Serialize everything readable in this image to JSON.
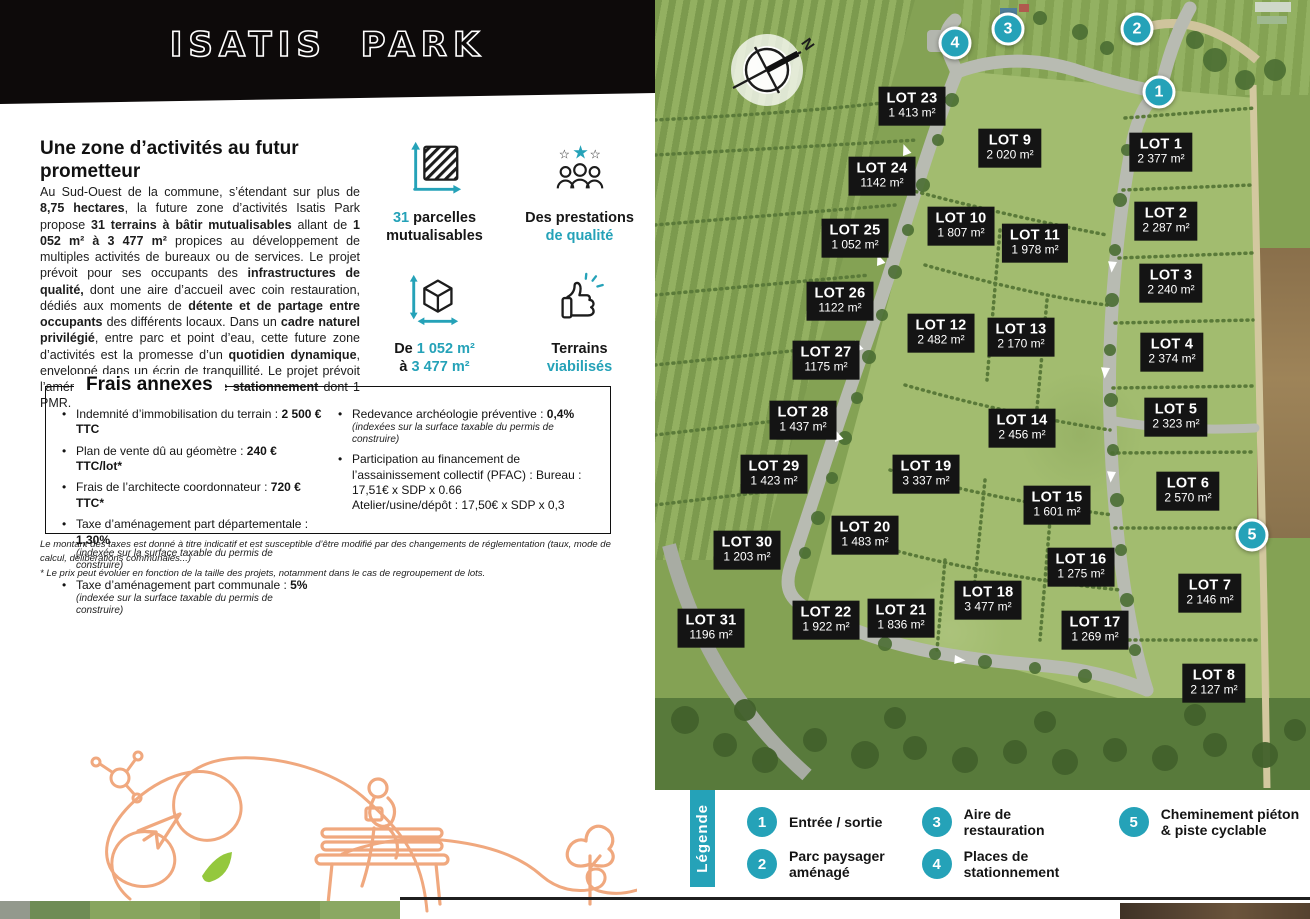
{
  "banner": {
    "title": "ISATIS PARK"
  },
  "intro": {
    "heading": "Une zone d’activités au futur prometteur",
    "paragraph": [
      {
        "t": "Au Sud-Ouest de la commune, s’étendant sur plus de "
      },
      {
        "t": "8,75 hectares",
        "b": 1
      },
      {
        "t": ", la future zone d’activités Isatis Park propose "
      },
      {
        "t": "31 terrains à bâtir mutualisables",
        "b": 1
      },
      {
        "t": " allant de "
      },
      {
        "t": "1 052 m² à 3 477 m²",
        "b": 1
      },
      {
        "t": " propices au développement de multiples activités de bureaux ou de services. Le projet prévoit pour ses occupants des "
      },
      {
        "t": "infrastructures de qualité,",
        "b": 1
      },
      {
        "t": " dont une aire d’accueil avec coin restauration, dédiés aux moments de "
      },
      {
        "t": "détente et de partage entre occupants",
        "b": 1
      },
      {
        "t": " des différents locaux. Dans un "
      },
      {
        "t": "cadre naturel privilégié",
        "b": 1
      },
      {
        "t": ", entre parc et point d’eau, cette future zone d’activités est la promesse d’un "
      },
      {
        "t": "quotidien dynamique",
        "b": 1
      },
      {
        "t": ", enveloppé dans un écrin de tranquillité. Le projet prévoit l’aménagement de "
      },
      {
        "t": "10 places de stationnement",
        "b": 1
      },
      {
        "t": " dont 1 PMR."
      }
    ]
  },
  "features": [
    {
      "icon": "area-icon",
      "l1": [
        {
          "t": "31 ",
          "a": 1
        },
        {
          "t": "parcelles"
        }
      ],
      "l2": [
        {
          "t": "mutualisables"
        }
      ]
    },
    {
      "icon": "quality-stars-people-icon",
      "l1": [
        {
          "t": "Des prestations"
        }
      ],
      "l2": [
        {
          "t": "de qualité",
          "a": 1
        }
      ]
    },
    {
      "icon": "plot-size-cube-icon",
      "l1": [
        {
          "t": "De "
        },
        {
          "t": "1 052 m²",
          "a": 1
        }
      ],
      "l2": [
        {
          "t": "à "
        },
        {
          "t": "3 477 m²",
          "a": 1
        }
      ]
    },
    {
      "icon": "thumb-up-icon",
      "l1": [
        {
          "t": "Terrains"
        }
      ],
      "l2": [
        {
          "t": "viabilisés",
          "a": 1
        }
      ]
    }
  ],
  "fees": {
    "title": "Frais annexes",
    "left": [
      {
        "label": "Indemnité d’immobilisation du terrain : ",
        "value": "2 500 € TTC"
      },
      {
        "label": "Plan de vente dû au géomètre : ",
        "value": "240 € TTC/lot*"
      },
      {
        "label": "Frais de l’architecte coordonnateur : ",
        "value": "720 € TTC*"
      },
      {
        "label": "Taxe d’aménagement part départementale : ",
        "value": "1,30%",
        "note": "(indexée sur la surface taxable du permis de construire)"
      },
      {
        "label": "Taxe d’aménagement part communale : ",
        "value": "5%",
        "note": "(indexée sur la surface taxable du permis de construire)"
      }
    ],
    "right": [
      {
        "label": "Redevance archéologie préventive : ",
        "value": "0,4%",
        "note": "(indexées sur la surface taxable du permis de construire)"
      },
      {
        "label": "Participation au financement de l’assainissement collectif (PFAC) : Bureau : 17,51€ x SDP x 0.66",
        "line2": "Atelier/usine/dépôt : 17,50€ x SDP x 0,3"
      }
    ]
  },
  "disclaimer": {
    "line1": "Le montant des taxes est donné à titre indicatif et est susceptible d’être modifié par des changements de réglementation (taux, mode de calcul, délibérations communales...)",
    "line2": "* Le prix peut évoluer en fonction de la taille des projets, notamment dans le cas de regroupement de lots."
  },
  "map": {
    "compass_label": "N",
    "lots": [
      {
        "name": "LOT 23",
        "area": "1 413 m²",
        "x": 257,
        "y": 106
      },
      {
        "name": "LOT 9",
        "area": "2 020 m²",
        "x": 355,
        "y": 148
      },
      {
        "name": "LOT 1",
        "area": "2 377 m²",
        "x": 506,
        "y": 152
      },
      {
        "name": "LOT 24",
        "area": "1142 m²",
        "x": 227,
        "y": 176
      },
      {
        "name": "LOT 2",
        "area": "2 287 m²",
        "x": 511,
        "y": 221
      },
      {
        "name": "LOT 25",
        "area": "1 052 m²",
        "x": 200,
        "y": 238
      },
      {
        "name": "LOT 10",
        "area": "1 807 m²",
        "x": 306,
        "y": 226
      },
      {
        "name": "LOT 11",
        "area": "1 978 m²",
        "x": 380,
        "y": 243
      },
      {
        "name": "LOT 3",
        "area": "2 240 m²",
        "x": 516,
        "y": 283
      },
      {
        "name": "LOT 26",
        "area": "1122 m²",
        "x": 185,
        "y": 301
      },
      {
        "name": "LOT 12",
        "area": "2 482 m²",
        "x": 286,
        "y": 333
      },
      {
        "name": "LOT 13",
        "area": "2 170 m²",
        "x": 366,
        "y": 337
      },
      {
        "name": "LOT 27",
        "area": "1175 m²",
        "x": 171,
        "y": 360
      },
      {
        "name": "LOT 4",
        "area": "2 374 m²",
        "x": 517,
        "y": 352
      },
      {
        "name": "LOT 28",
        "area": "1 437 m²",
        "x": 148,
        "y": 420
      },
      {
        "name": "LOT 14",
        "area": "2 456 m²",
        "x": 367,
        "y": 428
      },
      {
        "name": "LOT 5",
        "area": "2 323 m²",
        "x": 521,
        "y": 417
      },
      {
        "name": "LOT 29",
        "area": "1 423 m²",
        "x": 119,
        "y": 474
      },
      {
        "name": "LOT 19",
        "area": "3 337 m²",
        "x": 271,
        "y": 474
      },
      {
        "name": "LOT 15",
        "area": "1 601 m²",
        "x": 402,
        "y": 505
      },
      {
        "name": "LOT 6",
        "area": "2 570 m²",
        "x": 533,
        "y": 491
      },
      {
        "name": "LOT 30",
        "area": "1 203 m²",
        "x": 92,
        "y": 550
      },
      {
        "name": "LOT 20",
        "area": "1 483 m²",
        "x": 210,
        "y": 535
      },
      {
        "name": "LOT 16",
        "area": "1 275 m²",
        "x": 426,
        "y": 567
      },
      {
        "name": "LOT 18",
        "area": "3 477 m²",
        "x": 333,
        "y": 600
      },
      {
        "name": "LOT 7",
        "area": "2 146 m²",
        "x": 555,
        "y": 593
      },
      {
        "name": "LOT 22",
        "area": "1 922 m²",
        "x": 171,
        "y": 620
      },
      {
        "name": "LOT 21",
        "area": "1 836 m²",
        "x": 246,
        "y": 618
      },
      {
        "name": "LOT 31",
        "area": "1196 m²",
        "x": 56,
        "y": 628
      },
      {
        "name": "LOT 17",
        "area": "1 269 m²",
        "x": 440,
        "y": 630
      },
      {
        "name": "LOT 8",
        "area": "2 127 m²",
        "x": 559,
        "y": 683
      }
    ],
    "markers": [
      {
        "n": "1",
        "x": 504,
        "y": 92
      },
      {
        "n": "2",
        "x": 482,
        "y": 29
      },
      {
        "n": "3",
        "x": 353,
        "y": 29
      },
      {
        "n": "4",
        "x": 300,
        "y": 43
      },
      {
        "n": "5",
        "x": 597,
        "y": 535
      }
    ]
  },
  "legend": {
    "title": "Légende",
    "columns": [
      [
        {
          "n": "1",
          "label": "Entrée / sortie",
          "w": 130
        },
        {
          "n": "2",
          "label": "Parc paysager aménagé",
          "w": 108
        }
      ],
      [
        {
          "n": "3",
          "label": "Aire de restauration",
          "w": 170
        },
        {
          "n": "4",
          "label": "Places de stationnement",
          "w": 108
        }
      ],
      [
        {
          "n": "5",
          "label": "Cheminement piéton & piste cyclable",
          "w": 165
        }
      ]
    ]
  },
  "colors": {
    "accent_teal": "#25a2b8",
    "banner_black": "#0d0a0a",
    "lot_label_black": "#141414",
    "deco_orange": "#f0a87e",
    "leaf_green": "#94c83d"
  }
}
